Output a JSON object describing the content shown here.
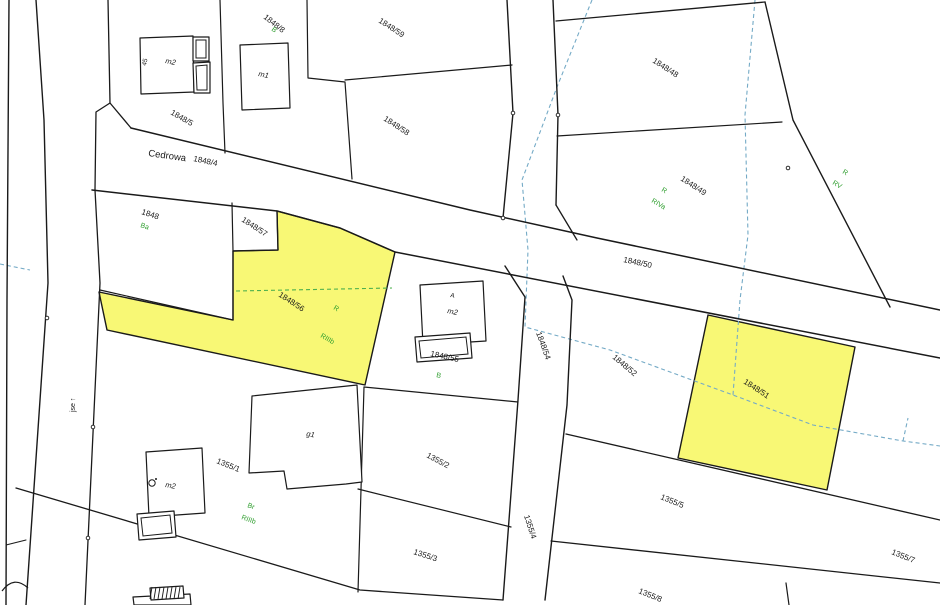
{
  "map": {
    "width": 940,
    "height": 605,
    "colors": {
      "background": "#ffffff",
      "boundary": "#1a1a1a",
      "highlight_fill": "#f8f875",
      "class_label": "#2f9e2f",
      "utility_line": "#74aac6",
      "landuse_dash": "#4db04d",
      "parcel_label": "#1a1a1a"
    },
    "highlight_parcels": [
      {
        "id": "1848/56",
        "points": [
          [
            99,
            292
          ],
          [
            233,
            320
          ],
          [
            233,
            251
          ],
          [
            278,
            250
          ],
          [
            277,
            211
          ],
          [
            340,
            228
          ],
          [
            395,
            252
          ],
          [
            365,
            385
          ],
          [
            107,
            330
          ]
        ]
      },
      {
        "id": "1848/51",
        "points": [
          [
            708,
            315
          ],
          [
            855,
            347
          ],
          [
            827,
            490
          ],
          [
            678,
            458
          ]
        ]
      }
    ],
    "boundaries": [
      {
        "pts": [
          [
            9,
            0
          ],
          [
            7,
            300
          ],
          [
            6,
            605
          ]
        ],
        "w": 1.4
      },
      {
        "pts": [
          [
            36,
            0
          ],
          [
            44,
            120
          ],
          [
            48,
            283
          ],
          [
            26,
            605
          ]
        ],
        "w": 1.4
      },
      {
        "pts": [
          [
            108,
            0
          ],
          [
            110,
            103
          ],
          [
            96,
            112
          ],
          [
            95,
            190
          ]
        ],
        "w": 1.3
      },
      {
        "pts": [
          [
            95,
            190
          ],
          [
            100,
            283
          ],
          [
            85,
            605
          ]
        ],
        "w": 1.3
      },
      {
        "pts": [
          [
            110,
            103
          ],
          [
            131,
            128
          ]
        ],
        "w": 1.3
      },
      {
        "pts": [
          [
            131,
            128
          ],
          [
            470,
            210
          ],
          [
            597,
            238
          ],
          [
            940,
            310
          ]
        ],
        "w": 1.5
      },
      {
        "pts": [
          [
            92,
            190
          ],
          [
            277,
            211
          ],
          [
            340,
            228
          ],
          [
            395,
            252
          ],
          [
            940,
            358
          ]
        ],
        "w": 1.5
      },
      {
        "pts": [
          [
            232,
            203
          ],
          [
            233,
            251
          ],
          [
            278,
            250
          ],
          [
            277,
            211
          ]
        ],
        "w": 1.2
      },
      {
        "pts": [
          [
            233,
            251
          ],
          [
            233,
            320
          ]
        ],
        "w": 1.2
      },
      {
        "pts": [
          [
            100,
            290
          ],
          [
            233,
            320
          ]
        ],
        "w": 1.2
      },
      {
        "pts": [
          [
            220,
            0
          ],
          [
            223,
            103
          ],
          [
            225,
            153
          ]
        ],
        "w": 1.2
      },
      {
        "pts": [
          [
            307,
            0
          ],
          [
            308,
            78
          ],
          [
            345,
            82
          ],
          [
            352,
            179
          ]
        ],
        "w": 1.2
      },
      {
        "pts": [
          [
            345,
            80
          ],
          [
            512,
            65
          ]
        ],
        "w": 1.2
      },
      {
        "pts": [
          [
            507,
            0
          ],
          [
            513,
            113
          ],
          [
            503,
            218
          ]
        ],
        "w": 1.4
      },
      {
        "pts": [
          [
            553,
            0
          ],
          [
            558,
            115
          ],
          [
            556,
            205
          ]
        ],
        "w": 1.4
      },
      {
        "pts": [
          [
            556,
            205
          ],
          [
            577,
            240
          ]
        ],
        "w": 1.3
      },
      {
        "pts": [
          [
            556,
            21
          ],
          [
            765,
            2
          ]
        ],
        "w": 1.3
      },
      {
        "pts": [
          [
            765,
            2
          ],
          [
            793,
            120
          ],
          [
            890,
            307
          ]
        ],
        "w": 1.4
      },
      {
        "pts": [
          [
            557,
            136
          ],
          [
            782,
            122
          ]
        ],
        "w": 1.2
      },
      {
        "pts": [
          [
            505,
            266
          ],
          [
            525,
            297
          ],
          [
            518,
            400
          ],
          [
            503,
            600
          ]
        ],
        "w": 1.4
      },
      {
        "pts": [
          [
            563,
            276
          ],
          [
            572,
            300
          ],
          [
            567,
            405
          ],
          [
            545,
            600
          ]
        ],
        "w": 1.4
      },
      {
        "pts": [
          [
            566,
            434
          ],
          [
            940,
            520
          ]
        ],
        "w": 1.3
      },
      {
        "pts": [
          [
            551,
            541
          ],
          [
            940,
            583
          ]
        ],
        "w": 1.3
      },
      {
        "pts": [
          [
            786,
            583
          ],
          [
            789,
            605
          ]
        ],
        "w": 1.2
      },
      {
        "pts": [
          [
            364,
            387
          ],
          [
            518,
            402
          ]
        ],
        "w": 1.2
      },
      {
        "pts": [
          [
            364,
            387
          ],
          [
            358,
            592
          ]
        ],
        "w": 1.2
      },
      {
        "pts": [
          [
            16,
            488
          ],
          [
            360,
            590
          ],
          [
            503,
            600
          ]
        ],
        "w": 1.3
      },
      {
        "pts": [
          [
            358,
            489
          ],
          [
            511,
            527
          ]
        ],
        "w": 1.2
      },
      {
        "pts": [
          [
            6,
            545
          ],
          [
            26,
            540
          ]
        ],
        "w": 1.1
      }
    ],
    "curves": [
      {
        "d": "M 2,591 Q 14,575 28,588",
        "w": 1.2
      }
    ],
    "dashed_lines": [
      {
        "color": "utility",
        "pts": [
          [
            592,
            0
          ],
          [
            557,
            87
          ],
          [
            522,
            180
          ],
          [
            528,
            250
          ],
          [
            525,
            327
          ],
          [
            610,
            350
          ],
          [
            733,
            395
          ],
          [
            813,
            425
          ],
          [
            903,
            441
          ],
          [
            940,
            446
          ]
        ]
      },
      {
        "color": "utility",
        "pts": [
          [
            903,
            441
          ],
          [
            908,
            418
          ]
        ]
      },
      {
        "color": "utility",
        "pts": [
          [
            755,
            0
          ],
          [
            745,
            115
          ],
          [
            748,
            235
          ],
          [
            740,
            300
          ],
          [
            733,
            395
          ]
        ]
      },
      {
        "color": "utility",
        "pts": [
          [
            0,
            264
          ],
          [
            30,
            270
          ]
        ]
      },
      {
        "color": "landuse",
        "pts": [
          [
            236,
            291
          ],
          [
            392,
            288
          ]
        ]
      }
    ],
    "buildings": [
      {
        "id": "building-m2-topleft",
        "outline": [
          [
            140,
            38
          ],
          [
            193,
            36
          ],
          [
            194,
            92
          ],
          [
            141,
            94
          ]
        ]
      },
      {
        "id": "building-m2-topleft-annex-1",
        "outline": [
          [
            193,
            37
          ],
          [
            209,
            37
          ],
          [
            209,
            61
          ],
          [
            193,
            61
          ]
        ],
        "inner": [
          [
            196,
            40
          ],
          [
            206,
            40
          ],
          [
            206,
            58
          ],
          [
            196,
            58
          ]
        ]
      },
      {
        "id": "building-m2-topleft-annex-2",
        "outline": [
          [
            193,
            63
          ],
          [
            210,
            62
          ],
          [
            210,
            93
          ],
          [
            194,
            93
          ]
        ],
        "inner": [
          [
            196,
            66
          ],
          [
            207,
            65
          ],
          [
            207,
            90
          ],
          [
            197,
            90
          ]
        ]
      },
      {
        "id": "building-m1",
        "outline": [
          [
            240,
            45
          ],
          [
            288,
            43
          ],
          [
            290,
            108
          ],
          [
            242,
            110
          ]
        ]
      },
      {
        "id": "building-m2-center",
        "outline": [
          [
            420,
            285
          ],
          [
            483,
            281
          ],
          [
            486,
            341
          ],
          [
            423,
            345
          ]
        ]
      },
      {
        "id": "building-m2-center-annex",
        "outline": [
          [
            415,
            337
          ],
          [
            470,
            333
          ],
          [
            472,
            358
          ],
          [
            417,
            362
          ]
        ],
        "inner": [
          [
            419,
            341
          ],
          [
            466,
            337
          ],
          [
            468,
            354
          ],
          [
            421,
            358
          ]
        ]
      },
      {
        "id": "building-g1",
        "outline": [
          [
            252,
            396
          ],
          [
            357,
            385
          ],
          [
            362,
            482
          ],
          [
            346,
            484
          ],
          [
            287,
            489
          ],
          [
            284,
            471
          ],
          [
            249,
            473
          ]
        ]
      },
      {
        "id": "building-m2-bottomleft",
        "outline": [
          [
            146,
            452
          ],
          [
            202,
            448
          ],
          [
            205,
            513
          ],
          [
            149,
            517
          ]
        ]
      },
      {
        "id": "building-m2-bottomleft-annex",
        "outline": [
          [
            137,
            514
          ],
          [
            174,
            511
          ],
          [
            176,
            537
          ],
          [
            139,
            540
          ]
        ],
        "inner": [
          [
            141,
            518
          ],
          [
            170,
            515
          ],
          [
            172,
            533
          ],
          [
            143,
            536
          ]
        ]
      },
      {
        "id": "building-bottom-partial",
        "outline": [
          [
            133,
            597
          ],
          [
            190,
            594
          ],
          [
            191,
            605
          ],
          [
            134,
            605
          ]
        ]
      },
      {
        "id": "building-bottom-hatched",
        "outline": [
          [
            150,
            588
          ],
          [
            183,
            586
          ],
          [
            184,
            598
          ],
          [
            151,
            600
          ]
        ],
        "hatch": true
      }
    ],
    "symbols": [
      {
        "type": "circle",
        "x": 152,
        "y": 483,
        "r": 3.2,
        "name": "well-symbol"
      }
    ],
    "vertex_dots": [
      [
        47,
        318
      ],
      [
        93,
        427
      ],
      [
        88,
        538
      ],
      [
        513,
        113
      ],
      [
        503,
        218
      ],
      [
        558,
        115
      ],
      [
        788,
        168
      ]
    ],
    "labels": [
      {
        "text": "1848/8",
        "x": 263,
        "y": 18,
        "rot": 38,
        "kind": "parcel"
      },
      {
        "text": "B",
        "x": 271,
        "y": 30,
        "rot": 38,
        "kind": "class"
      },
      {
        "text": "1848/5",
        "x": 170,
        "y": 114,
        "rot": 30,
        "kind": "parcel"
      },
      {
        "text": "Cedrowa",
        "x": 148,
        "y": 156,
        "rot": 8,
        "kind": "street"
      },
      {
        "text": "1848/4",
        "x": 193,
        "y": 161,
        "rot": 12,
        "kind": "parcel"
      },
      {
        "text": "1848/59",
        "x": 378,
        "y": 22,
        "rot": 33,
        "kind": "parcel"
      },
      {
        "text": "1848/58",
        "x": 383,
        "y": 120,
        "rot": 33,
        "kind": "parcel"
      },
      {
        "text": "1848/48",
        "x": 652,
        "y": 62,
        "rot": 33,
        "kind": "parcel"
      },
      {
        "text": "1848/49",
        "x": 680,
        "y": 180,
        "rot": 33,
        "kind": "parcel"
      },
      {
        "text": "R",
        "x": 661,
        "y": 191,
        "rot": 30,
        "kind": "class"
      },
      {
        "text": "RIVa",
        "x": 651,
        "y": 202,
        "rot": 30,
        "kind": "class"
      },
      {
        "text": "R",
        "x": 842,
        "y": 173,
        "rot": 30,
        "kind": "class"
      },
      {
        "text": "RV",
        "x": 832,
        "y": 184,
        "rot": 30,
        "kind": "class"
      },
      {
        "text": "1848",
        "x": 141,
        "y": 214,
        "rot": 18,
        "kind": "parcel"
      },
      {
        "text": "Ba",
        "x": 140,
        "y": 227,
        "rot": 18,
        "kind": "class"
      },
      {
        "text": "1848/57",
        "x": 241,
        "y": 221,
        "rot": 33,
        "kind": "parcel"
      },
      {
        "text": "1848/56",
        "x": 278,
        "y": 296,
        "rot": 33,
        "kind": "parcel"
      },
      {
        "text": "R",
        "x": 333,
        "y": 309,
        "rot": 30,
        "kind": "class"
      },
      {
        "text": "RIIIb",
        "x": 320,
        "y": 337,
        "rot": 30,
        "kind": "class"
      },
      {
        "text": "1848/50",
        "x": 623,
        "y": 262,
        "rot": 12,
        "kind": "parcel"
      },
      {
        "text": "1848/55",
        "x": 430,
        "y": 356,
        "rot": 12,
        "kind": "parcel"
      },
      {
        "text": "B",
        "x": 436,
        "y": 377,
        "rot": 12,
        "kind": "class"
      },
      {
        "text": "1848/54",
        "x": 536,
        "y": 333,
        "rot": 70,
        "kind": "parcel"
      },
      {
        "text": "1848/52",
        "x": 612,
        "y": 358,
        "rot": 40,
        "kind": "parcel"
      },
      {
        "text": "1848/51",
        "x": 743,
        "y": 383,
        "rot": 33,
        "kind": "parcel"
      },
      {
        "text": "jse ↑",
        "x": 75,
        "y": 412,
        "rot": -90,
        "kind": "road"
      },
      {
        "text": "1355/1",
        "x": 216,
        "y": 463,
        "rot": 22,
        "kind": "parcel"
      },
      {
        "text": "Br",
        "x": 247,
        "y": 507,
        "rot": 20,
        "kind": "class"
      },
      {
        "text": "RIIIb",
        "x": 241,
        "y": 519,
        "rot": 20,
        "kind": "class"
      },
      {
        "text": "g1",
        "x": 306,
        "y": 436,
        "rot": 10,
        "kind": "building"
      },
      {
        "text": "m2",
        "x": 165,
        "y": 63,
        "rot": 12,
        "kind": "building"
      },
      {
        "text": "45",
        "x": 146,
        "y": 66,
        "rot": -78,
        "kind": "house_no"
      },
      {
        "text": "m1",
        "x": 258,
        "y": 76,
        "rot": 12,
        "kind": "building"
      },
      {
        "text": "m2",
        "x": 447,
        "y": 313,
        "rot": 12,
        "kind": "building"
      },
      {
        "text": "A",
        "x": 450,
        "y": 297,
        "rot": 12,
        "kind": "house_no"
      },
      {
        "text": "m2",
        "x": 165,
        "y": 487,
        "rot": 10,
        "kind": "building"
      },
      {
        "text": "1355/2",
        "x": 426,
        "y": 457,
        "rot": 28,
        "kind": "parcel"
      },
      {
        "text": "1355/3",
        "x": 413,
        "y": 554,
        "rot": 18,
        "kind": "parcel"
      },
      {
        "text": "1355/4",
        "x": 524,
        "y": 516,
        "rot": 72,
        "kind": "parcel"
      },
      {
        "text": "1355/5",
        "x": 660,
        "y": 499,
        "rot": 22,
        "kind": "parcel"
      },
      {
        "text": "1355/7",
        "x": 891,
        "y": 554,
        "rot": 22,
        "kind": "parcel"
      },
      {
        "text": "1355/8",
        "x": 638,
        "y": 593,
        "rot": 22,
        "kind": "parcel"
      }
    ]
  }
}
